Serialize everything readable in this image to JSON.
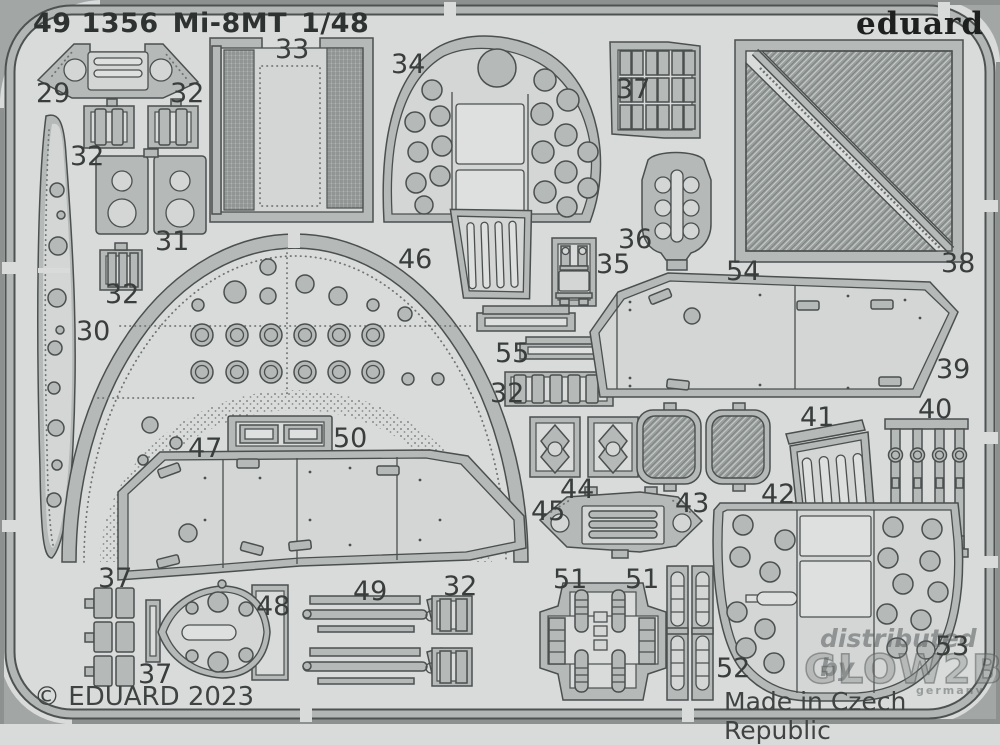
{
  "header": {
    "catalog_number": "49 1356",
    "kit_name": "Mi-8MT",
    "scale": "1/48"
  },
  "brand": {
    "logo_text": "eduard"
  },
  "footer": {
    "copyright": "© EDUARD 2023",
    "origin": "Made in Czech Republic"
  },
  "watermark": {
    "line1": "distributed by",
    "line2": "GLOW2B",
    "line3": "germany"
  },
  "colors": {
    "sheet_background": "#d8dbda",
    "part_metal": "#b5b9b8",
    "part_plate": "#d3d6d5",
    "outline": "#4b504f",
    "mesh": "#999e9d",
    "label_text": "#393d3c"
  },
  "part_labels": [
    {
      "text": "29"
    },
    {
      "text": "32"
    },
    {
      "text": "32"
    },
    {
      "text": "31"
    },
    {
      "text": "32"
    },
    {
      "text": "30"
    },
    {
      "text": "33"
    },
    {
      "text": "34"
    },
    {
      "text": "37"
    },
    {
      "text": "36"
    },
    {
      "text": "35"
    },
    {
      "text": "54"
    },
    {
      "text": "38"
    },
    {
      "text": "46"
    },
    {
      "text": "55"
    },
    {
      "text": "32"
    },
    {
      "text": "39"
    },
    {
      "text": "40"
    },
    {
      "text": "41"
    },
    {
      "text": "44"
    },
    {
      "text": "43"
    },
    {
      "text": "42"
    },
    {
      "text": "45"
    },
    {
      "text": "50"
    },
    {
      "text": "47"
    },
    {
      "text": "37"
    },
    {
      "text": "48"
    },
    {
      "text": "49"
    },
    {
      "text": "37"
    },
    {
      "text": "32"
    },
    {
      "text": "51"
    },
    {
      "text": "51"
    },
    {
      "text": "52"
    },
    {
      "text": "53"
    }
  ]
}
